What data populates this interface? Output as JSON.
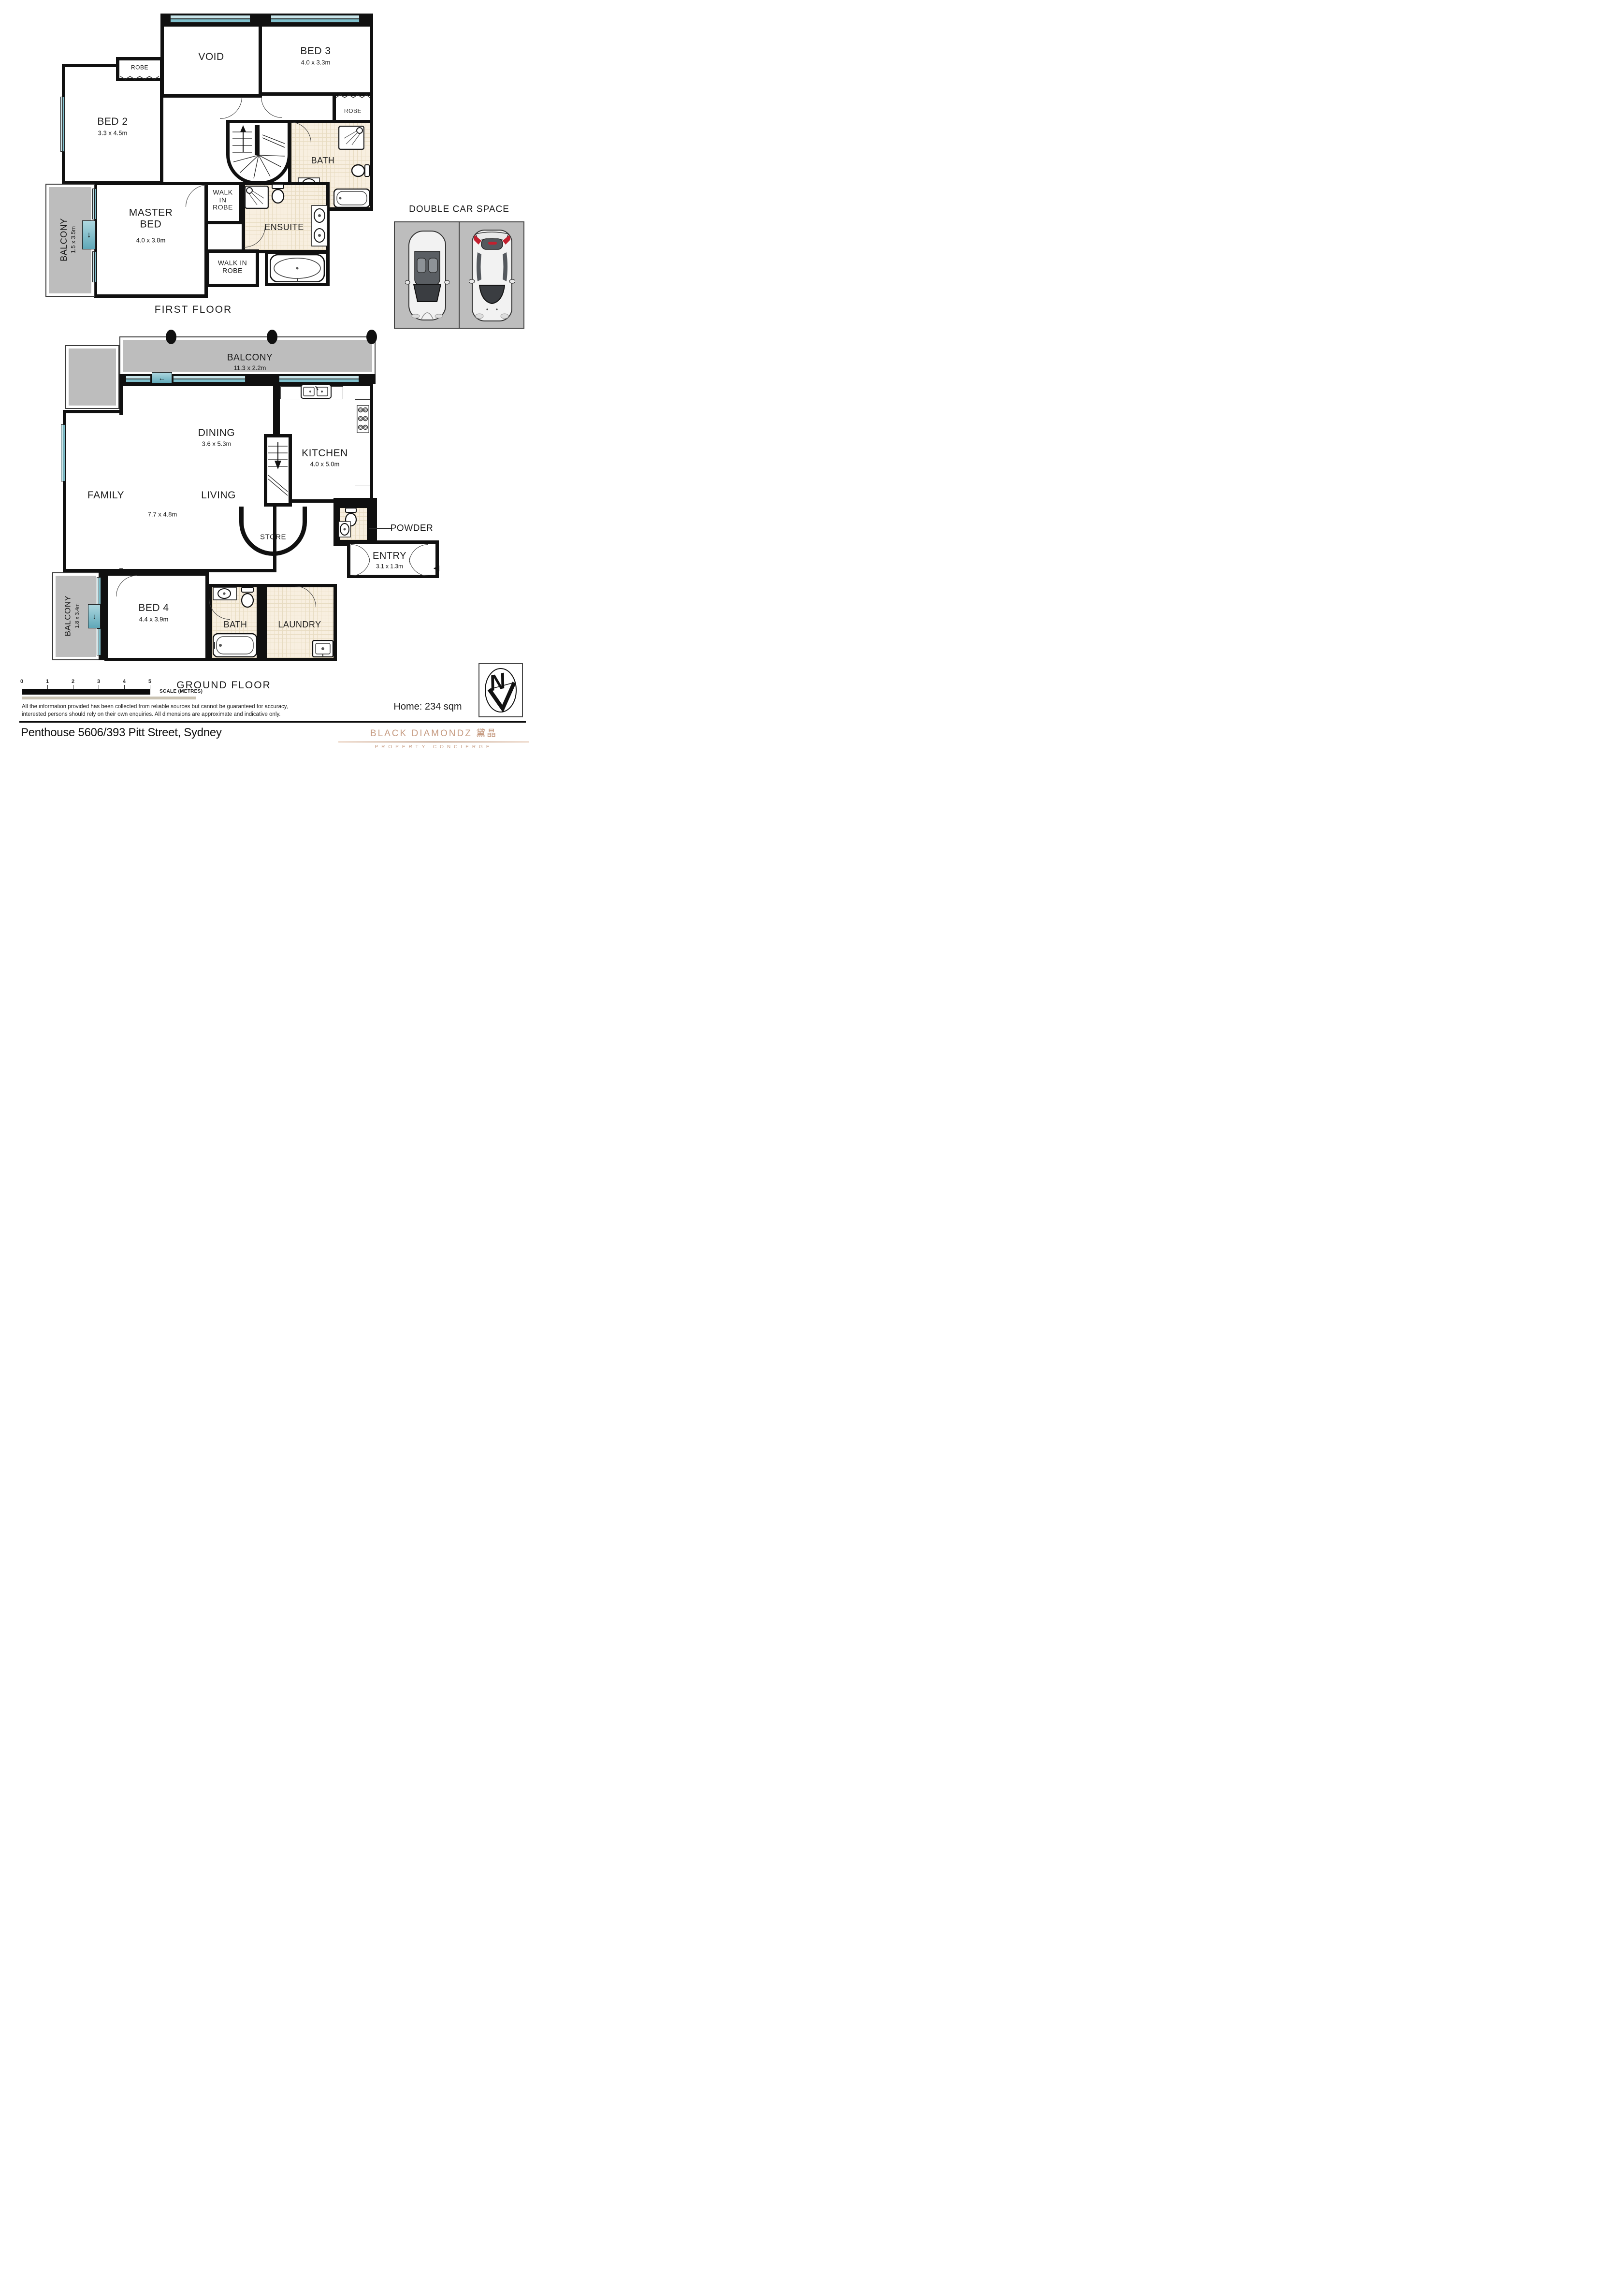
{
  "first_floor": {
    "title": "FIRST FLOOR",
    "rooms": {
      "void": {
        "label": "VOID"
      },
      "bed3": {
        "label": "BED 3",
        "dims": "4.0 x 3.3m"
      },
      "robe3": {
        "label": "ROBE"
      },
      "robe2": {
        "label": "ROBE"
      },
      "bed2": {
        "label": "BED 2",
        "dims": "3.3 x 4.5m"
      },
      "bath": {
        "label": "BATH"
      },
      "ensuite": {
        "label": "ENSUITE"
      },
      "wir_upper": {
        "label": "WALK IN ROBE"
      },
      "wir_lower": {
        "label": "WALK IN ROBE"
      },
      "master": {
        "label": "MASTER BED",
        "dims": "4.0 x 3.8m"
      },
      "balcony": {
        "label": "BALCONY",
        "dims": "1.5 x 3.5m"
      }
    }
  },
  "ground_floor": {
    "title": "GROUND FLOOR",
    "rooms": {
      "balcony_top": {
        "label": "BALCONY",
        "dims": "11.3 x 2.2m"
      },
      "dining": {
        "label": "DINING",
        "dims": "3.6 x 5.3m"
      },
      "kitchen": {
        "label": "KITCHEN",
        "dims": "4.0 x 5.0m"
      },
      "family": {
        "label": "FAMILY"
      },
      "living": {
        "label": "LIVING"
      },
      "living_dims": "7.7 x 4.8m",
      "store": {
        "label": "STORE"
      },
      "powder": {
        "label": "POWDER"
      },
      "entry": {
        "label": "ENTRY",
        "dims": "3.1 x 1.3m"
      },
      "bed4": {
        "label": "BED 4",
        "dims": "4.4 x 3.9m"
      },
      "bath": {
        "label": "BATH"
      },
      "laundry": {
        "label": "LAUNDRY"
      },
      "balcony_left": {
        "label": "BALCONY",
        "dims": "1.8 x 3.4m"
      }
    }
  },
  "car_space": {
    "title": "DOUBLE CAR SPACE"
  },
  "scale_bar": {
    "ticks": [
      "0",
      "1",
      "2",
      "3",
      "4",
      "5"
    ],
    "label": "SCALE (METRES)"
  },
  "disclaimer": {
    "line1": "All the information provided has been collected from reliable sources but cannot be guaranteed for accuracy,",
    "line2": "interested persons should rely on their own enquiries. All dimensions are approximate and indicative only."
  },
  "summary": {
    "home_area": "Home: 234 sqm"
  },
  "address": "Penthouse 5606/393 Pitt Street, Sydney",
  "brand": {
    "name": "BLACK DIAMONDZ 黛晶",
    "tagline": "PROPERTY CONCIERGE"
  },
  "compass": {
    "letter": "N"
  },
  "colors": {
    "window": "#7fc0cc",
    "balcony": "#bdbdbd",
    "tile": "#f8efe0",
    "wall": "#101010",
    "brand": "#c59a80"
  }
}
